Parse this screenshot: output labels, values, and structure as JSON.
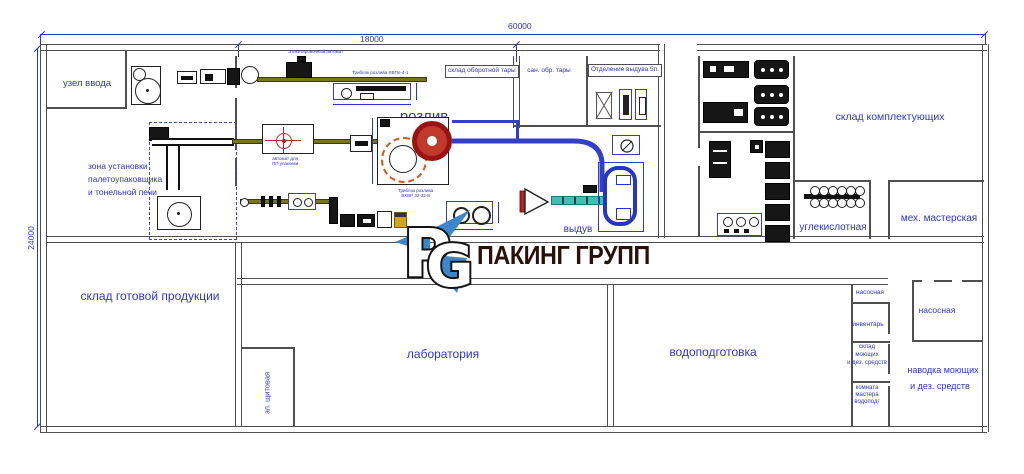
{
  "dims": {
    "total_width": "60000",
    "line_width": "18000",
    "total_height": "24000"
  },
  "rooms": {
    "uzel_vvoda": "узел ввода",
    "zona_1": "зона установки",
    "zona_2": "палетоупаковщика",
    "zona_3": "и тонельной печи",
    "rozliv": "розлив",
    "vyduv": "выдув",
    "sklad_oborot": "склад оборотной тары",
    "san_obr": "сан. обр. тары",
    "otdelenie": "Отделение выдува 5п.",
    "sklad_kompl": "склад комплектующих",
    "uglekislot": "углекислотная",
    "meh_master": "мех. мастерская",
    "sklad_gotov": "склад готовой продукции",
    "el_shchit": "эл. щитовая",
    "laboratoria": "лаборатория",
    "vodopodgotovka": "водоподготовка",
    "nasos_small": "насосная",
    "inventar": "инвентарь",
    "sklad_moy_1": "склад",
    "sklad_moy_2": "моющих",
    "sklad_moy_3": "и дез. средств",
    "komnata_1": "комната",
    "komnata_2": "мастера",
    "komnata_3": "водоподг",
    "nasos_big": "насосная",
    "navodka_1": "наводка моющих",
    "navodka_2": "и дез. средств"
  },
  "equipment": {
    "etiket": "Этикетировочный автомат",
    "triblok1": "Триблок розлива ХВПл-4-1",
    "avtomat_1": "автомат для",
    "avtomat_2": "ПП упаковки",
    "triblok2_1": "Триблок розлива",
    "triblok2_2": "ВХВР 32-32-8"
  },
  "logo": {
    "letter_p": "P",
    "letter_g": "G",
    "brand": "ПАКИНГ ГРУПП"
  },
  "colors": {
    "label_blue": "#2f35c4",
    "wall_gray": "#4f4f4f",
    "dim_blue": "#2b35c8",
    "conveyor_olive": "#76761f",
    "conveyor_teal": "#45bcb4",
    "carousel_red": "#9b1212",
    "logo_blue": "#3d86c8",
    "brand_brown": "#2a1006"
  }
}
